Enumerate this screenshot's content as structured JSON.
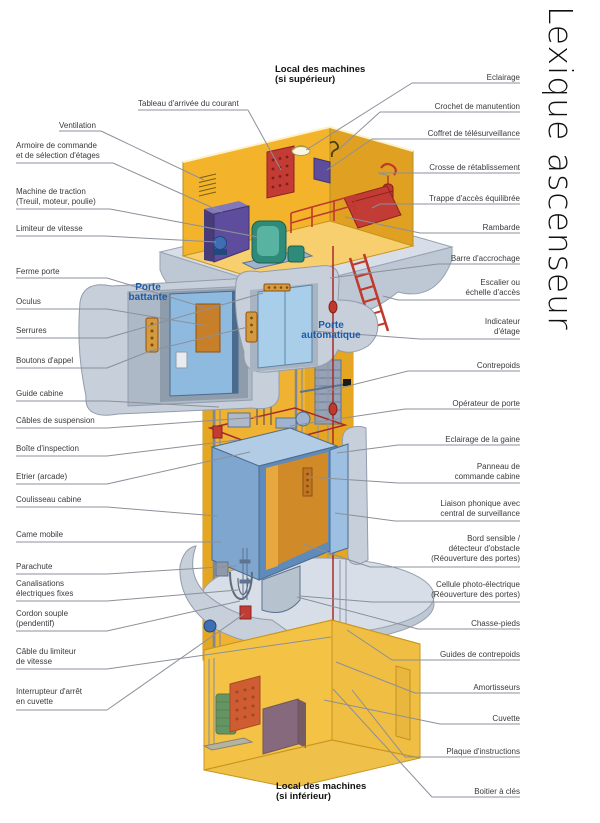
{
  "title": "Lexique ascenseur",
  "headings": {
    "machine_room_top": [
      "Local des machines",
      "(si supérieur)"
    ],
    "machine_room_bottom": [
      "Local des machines",
      "(si inférieur)"
    ]
  },
  "door_type_labels": {
    "battante": [
      "Porte",
      "battante"
    ],
    "automatique": [
      "Porte",
      "automatique"
    ]
  },
  "labels": {
    "left": [
      {
        "lines": [
          "Tableau d'arrivée du courant"
        ],
        "x": 138,
        "y": 99,
        "ul": [
          138,
          248,
          110
        ],
        "leader": [
          [
            248,
            110
          ],
          [
            281,
            170
          ]
        ]
      },
      {
        "lines": [
          "Ventilation"
        ],
        "x": 59,
        "y": 121,
        "ul": [
          59,
          101,
          131
        ],
        "leader": [
          [
            101,
            131
          ],
          [
            204,
            180
          ]
        ]
      },
      {
        "lines": [
          "Armoire de commande",
          "et de sélection d'étages"
        ],
        "x": 16,
        "y": 141,
        "ul": [
          16,
          113,
          163
        ],
        "leader": [
          [
            113,
            163
          ],
          [
            222,
            212
          ]
        ]
      },
      {
        "lines": [
          "Machine de traction",
          "(Treuil, moteur, poulie)"
        ],
        "x": 16,
        "y": 187,
        "ul": [
          16,
          110,
          209
        ],
        "leader": [
          [
            110,
            209
          ],
          [
            258,
            237
          ]
        ]
      },
      {
        "lines": [
          "Limiteur de vitesse"
        ],
        "x": 16,
        "y": 224,
        "ul": [
          16,
          105,
          236
        ],
        "leader": [
          [
            105,
            236
          ],
          [
            216,
            242
          ]
        ]
      },
      {
        "lines": [
          "Ferme porte"
        ],
        "x": 16,
        "y": 267,
        "ul": [
          16,
          107,
          278
        ],
        "leader": [
          [
            107,
            278
          ],
          [
            206,
            308
          ]
        ]
      },
      {
        "lines": [
          "Oculus"
        ],
        "x": 16,
        "y": 297,
        "ul": [
          16,
          107,
          309
        ],
        "leader": [
          [
            107,
            309
          ],
          [
            208,
            326
          ]
        ]
      },
      {
        "lines": [
          "Serrures"
        ],
        "x": 16,
        "y": 326,
        "ul": [
          16,
          107,
          338
        ],
        "leader": [
          [
            107,
            338
          ],
          [
            263,
            293
          ]
        ]
      },
      {
        "lines": [
          "Boutons d'appel"
        ],
        "x": 16,
        "y": 356,
        "ul": [
          16,
          107,
          368
        ],
        "leader": [
          [
            107,
            368
          ],
          [
            150,
            351
          ],
          [
            248,
            327
          ]
        ]
      },
      {
        "lines": [
          "Guide cabine"
        ],
        "x": 16,
        "y": 389,
        "ul": [
          16,
          107,
          401
        ],
        "leader": [
          [
            107,
            401
          ],
          [
            219,
            407
          ]
        ]
      },
      {
        "lines": [
          "Câbles de suspension"
        ],
        "x": 16,
        "y": 416,
        "ul": [
          16,
          107,
          428
        ],
        "leader": [
          [
            107,
            428
          ],
          [
            261,
            417
          ]
        ]
      },
      {
        "lines": [
          "Boîte d'inspection"
        ],
        "x": 16,
        "y": 444,
        "ul": [
          16,
          107,
          456
        ],
        "leader": [
          [
            107,
            456
          ],
          [
            237,
            440
          ]
        ]
      },
      {
        "lines": [
          "Etrier (arcade)"
        ],
        "x": 16,
        "y": 472,
        "ul": [
          16,
          107,
          484
        ],
        "leader": [
          [
            107,
            484
          ],
          [
            250,
            452
          ]
        ]
      },
      {
        "lines": [
          "Coulisseau cabine"
        ],
        "x": 16,
        "y": 495,
        "ul": [
          16,
          107,
          507
        ],
        "leader": [
          [
            107,
            507
          ],
          [
            217,
            516
          ]
        ]
      },
      {
        "lines": [
          "Came mobile"
        ],
        "x": 16,
        "y": 530,
        "ul": [
          16,
          107,
          542
        ],
        "leader": [
          [
            107,
            542
          ],
          [
            221,
            542
          ]
        ]
      },
      {
        "lines": [
          "Parachute"
        ],
        "x": 16,
        "y": 562,
        "ul": [
          16,
          107,
          574
        ],
        "leader": [
          [
            107,
            574
          ],
          [
            236,
            566
          ]
        ]
      },
      {
        "lines": [
          "Canalisations",
          "électriques fixes"
        ],
        "x": 16,
        "y": 579,
        "ul": [
          16,
          107,
          601
        ],
        "leader": [
          [
            107,
            601
          ],
          [
            238,
            590
          ]
        ]
      },
      {
        "lines": [
          "Cordon souple",
          "(pendentif)"
        ],
        "x": 16,
        "y": 609,
        "ul": [
          16,
          107,
          631
        ],
        "leader": [
          [
            107,
            631
          ],
          [
            240,
            601
          ]
        ]
      },
      {
        "lines": [
          "Câble du limiteur",
          "de vitesse"
        ],
        "x": 16,
        "y": 647,
        "ul": [
          16,
          107,
          669
        ],
        "leader": [
          [
            107,
            669
          ],
          [
            331,
            637
          ]
        ]
      },
      {
        "lines": [
          "Interrupteur d'arrêt",
          "en cuvette"
        ],
        "x": 16,
        "y": 687,
        "ul": [
          16,
          107,
          710
        ],
        "leader": [
          [
            107,
            710
          ],
          [
            244,
            614
          ]
        ]
      }
    ],
    "right": [
      {
        "lines": [
          "Eclairage"
        ],
        "y": 73,
        "ul": [
          412,
          520,
          83
        ],
        "leader": [
          [
            412,
            83
          ],
          [
            306,
            150
          ]
        ]
      },
      {
        "lines": [
          "Crochet de manutention"
        ],
        "y": 102,
        "ul": [
          380,
          520,
          112
        ],
        "leader": [
          [
            380,
            112
          ],
          [
            338,
            150
          ]
        ]
      },
      {
        "lines": [
          "Coffret de télésurveillance"
        ],
        "y": 129,
        "ul": [
          372,
          520,
          139
        ],
        "leader": [
          [
            372,
            139
          ],
          [
            327,
            170
          ]
        ]
      },
      {
        "lines": [
          "Crosse de rétablissement"
        ],
        "y": 163,
        "ul": [
          378,
          520,
          173
        ],
        "leader": [
          [
            378,
            173
          ],
          [
            390,
            176
          ]
        ]
      },
      {
        "lines": [
          "Trappe d'accès équilibrée"
        ],
        "y": 194,
        "ul": [
          380,
          520,
          204
        ],
        "leader": [
          [
            380,
            204
          ],
          [
            372,
            208
          ]
        ]
      },
      {
        "lines": [
          "Rambarde"
        ],
        "y": 223,
        "ul": [
          420,
          520,
          233
        ],
        "leader": [
          [
            420,
            233
          ],
          [
            345,
            217
          ]
        ]
      },
      {
        "lines": [
          "Barre d'accrochage"
        ],
        "y": 254,
        "ul": [
          438,
          520,
          264
        ],
        "leader": [
          [
            438,
            264
          ],
          [
            330,
            278
          ]
        ]
      },
      {
        "lines": [
          "Escalier ou",
          "échelle d'accès"
        ],
        "y": 278,
        "ul": [
          398,
          520,
          300
        ],
        "leader": [
          [
            398,
            300
          ],
          [
            383,
            296
          ]
        ]
      },
      {
        "lines": [
          "Indicateur",
          "d'étage"
        ],
        "y": 317,
        "ul": [
          420,
          520,
          339
        ],
        "leader": [
          [
            420,
            339
          ],
          [
            312,
            331
          ]
        ]
      },
      {
        "lines": [
          "Contrepoids"
        ],
        "y": 361,
        "ul": [
          408,
          520,
          371
        ],
        "leader": [
          [
            408,
            371
          ],
          [
            328,
            391
          ]
        ]
      },
      {
        "lines": [
          "Opérateur de porte"
        ],
        "y": 399,
        "ul": [
          405,
          520,
          409
        ],
        "leader": [
          [
            405,
            409
          ],
          [
            290,
            426
          ]
        ]
      },
      {
        "lines": [
          "Eclairage de la gaine"
        ],
        "y": 435,
        "ul": [
          398,
          520,
          445
        ],
        "leader": [
          [
            398,
            445
          ],
          [
            337,
            453
          ]
        ]
      },
      {
        "lines": [
          "Panneau de",
          "commande cabine"
        ],
        "y": 462,
        "ul": [
          398,
          520,
          483
        ],
        "leader": [
          [
            398,
            483
          ],
          [
            308,
            477
          ]
        ]
      },
      {
        "lines": [
          "Liaison phonique avec",
          "central de surveillance"
        ],
        "y": 499,
        "ul": [
          395,
          520,
          521
        ],
        "leader": [
          [
            395,
            521
          ],
          [
            335,
            513
          ]
        ]
      },
      {
        "lines": [
          "Bord sensible /",
          "détecteur d'obstacle",
          "(Réouverture des portes)"
        ],
        "y": 534,
        "ul": [
          370,
          520,
          567
        ],
        "leader": [
          [
            370,
            567
          ],
          [
            303,
            544
          ]
        ]
      },
      {
        "lines": [
          "Cellule photo-électrique",
          "(Réouverture des portes)"
        ],
        "y": 580,
        "ul": [
          372,
          520,
          602
        ],
        "leader": [
          [
            372,
            602
          ],
          [
            300,
            596
          ]
        ]
      },
      {
        "lines": [
          "Chasse-pieds"
        ],
        "y": 619,
        "ul": [
          418,
          520,
          629
        ],
        "leader": [
          [
            418,
            629
          ],
          [
            297,
            597
          ]
        ]
      },
      {
        "lines": [
          "Guides de contrepoids"
        ],
        "y": 650,
        "ul": [
          392,
          520,
          660
        ],
        "leader": [
          [
            392,
            660
          ],
          [
            347,
            630
          ]
        ]
      },
      {
        "lines": [
          "Amortisseurs"
        ],
        "y": 683,
        "ul": [
          415,
          520,
          693
        ],
        "leader": [
          [
            415,
            693
          ],
          [
            336,
            662
          ]
        ]
      },
      {
        "lines": [
          "Cuvette"
        ],
        "y": 714,
        "ul": [
          440,
          520,
          724
        ],
        "leader": [
          [
            440,
            724
          ],
          [
            324,
            700
          ]
        ]
      },
      {
        "lines": [
          "Plaque d'instructions"
        ],
        "y": 747,
        "ul": [
          405,
          520,
          757
        ],
        "leader": [
          [
            405,
            757
          ],
          [
            352,
            690
          ]
        ]
      },
      {
        "lines": [
          "Boitier à clés"
        ],
        "y": 787,
        "ul": [
          432,
          520,
          797
        ],
        "leader": [
          [
            432,
            797
          ],
          [
            333,
            689
          ]
        ]
      }
    ]
  },
  "palette": {
    "shaft_yellow": "#F0B232",
    "shaft_shade": "#E5A722",
    "wall_top": "#F7CF6E",
    "concrete": "#C7CFDA",
    "concrete_light": "#D7DEE7",
    "concrete_edge": "#97A2B2",
    "cabin_blue": "#7FA6CF",
    "door_blue": "#A9CEEA",
    "interior_orange": "#D08A28",
    "accent_red": "#C23B35",
    "machine_teal": "#2E8B7A",
    "cabinet_purple": "#5D4D9C",
    "label_blue": "#1B5BA8",
    "leader_gray": "#8B9099"
  }
}
